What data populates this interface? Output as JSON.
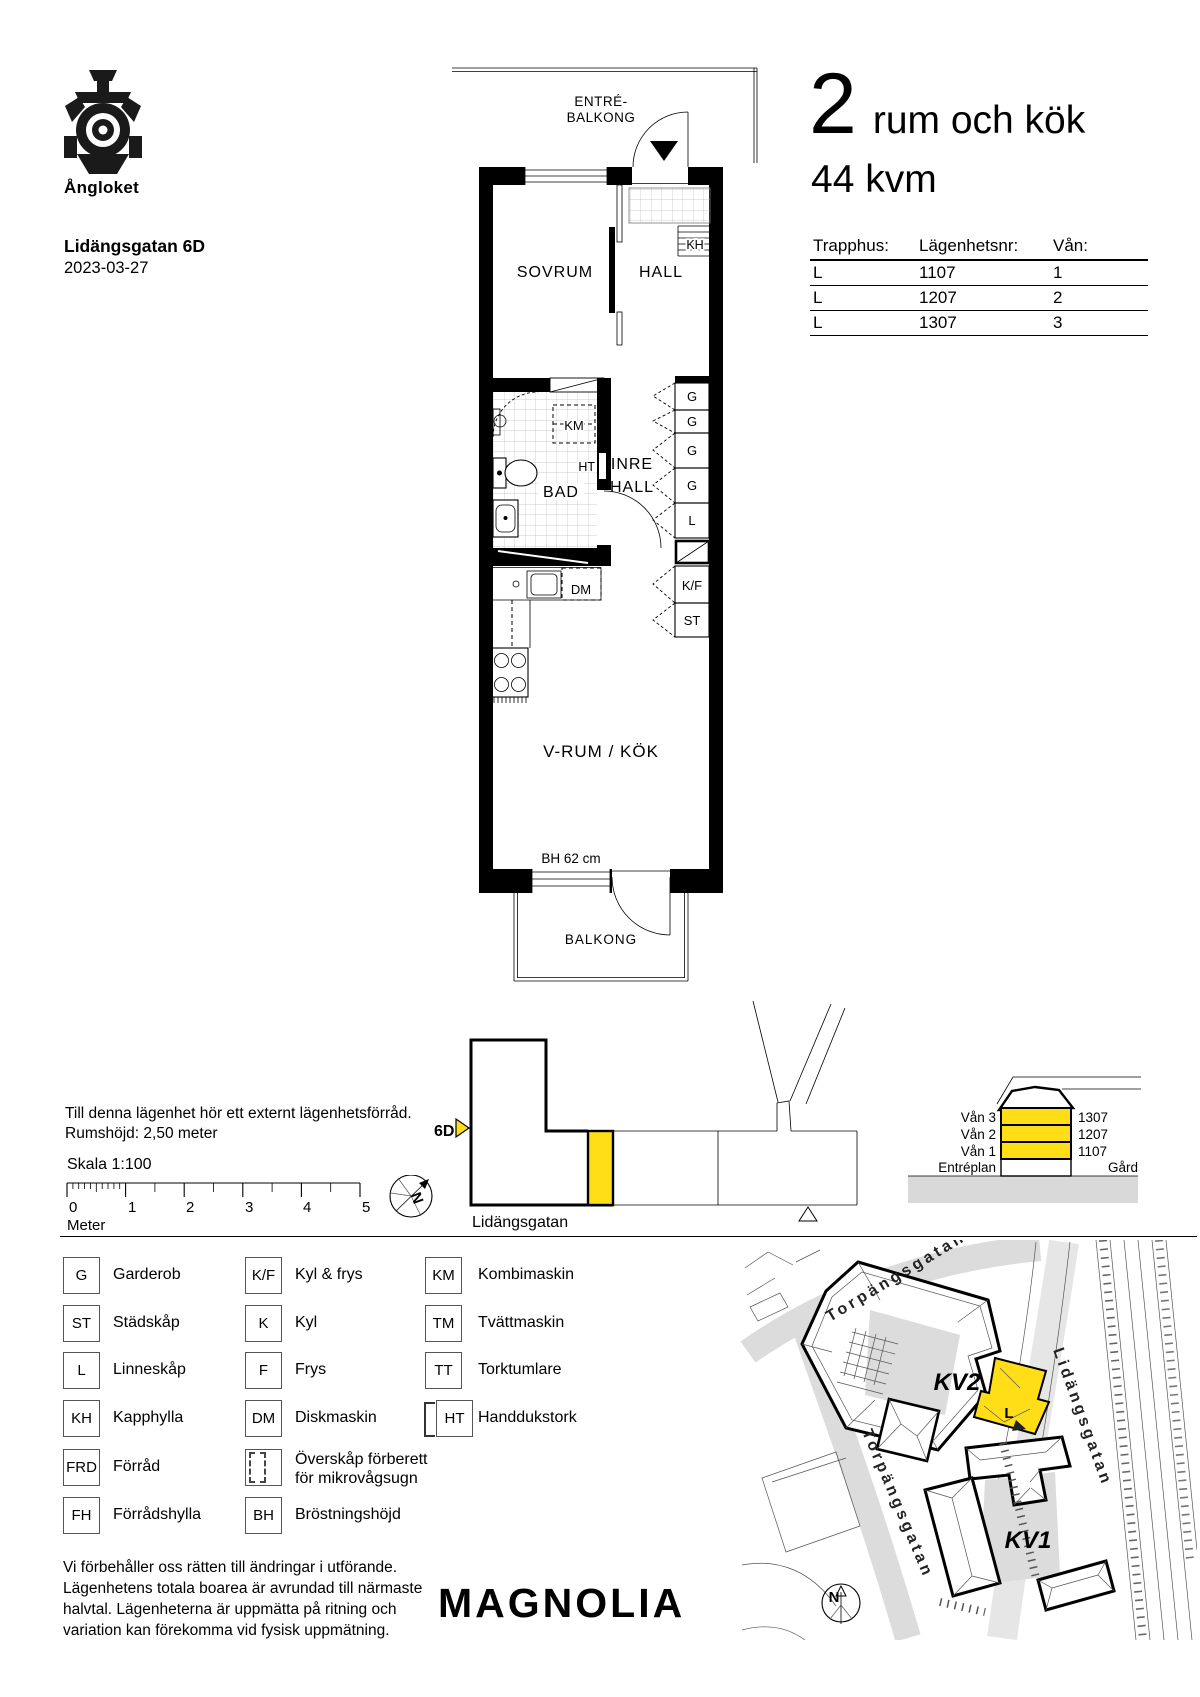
{
  "header": {
    "logo_text": "Ångloket",
    "address": "Lidängsgatan 6D",
    "date": "2023-03-27",
    "rooms_count": "2",
    "rooms_label": "rum och kök",
    "area": "44 kvm"
  },
  "apartments_table": {
    "col_trapphus": "Trapphus:",
    "col_lagenhetsnr": "Lägenhetsnr:",
    "col_van": "Vån:",
    "rows": [
      {
        "trapphus": "L",
        "nr": "1107",
        "van": "1"
      },
      {
        "trapphus": "L",
        "nr": "1207",
        "van": "2"
      },
      {
        "trapphus": "L",
        "nr": "1307",
        "van": "3"
      }
    ]
  },
  "floor_plan": {
    "entre_balkong_line1": "ENTRÉ-",
    "entre_balkong_line2": "BALKONG",
    "sovrum": "SOVRUM",
    "hall": "HALL",
    "kh": "KH",
    "km": "KM",
    "ht": "HT",
    "bad": "BAD",
    "inre_hall_line1": "INRE",
    "inre_hall_line2": "HALL",
    "dm": "DM",
    "closets": [
      "G",
      "G",
      "G",
      "G",
      "L"
    ],
    "kf": "K/F",
    "st": "ST",
    "vrum_kok": "V-RUM / KÖK",
    "bh": "BH 62 cm",
    "balkong": "BALKONG"
  },
  "notes": {
    "line1": "Till denna lägenhet hör ett externt lägenhetsförråd.",
    "line2": "Rumshöjd: 2,50 meter"
  },
  "scale_bar": {
    "title": "Skala 1:100",
    "ticks": [
      "0",
      "1",
      "2",
      "3",
      "4",
      "5"
    ],
    "unit": "Meter",
    "north": "N"
  },
  "site_plan": {
    "unit_marker": "6D",
    "street": "Lidängsgatan"
  },
  "elevation": {
    "floors": [
      {
        "label": "Vån 3",
        "nr": "1307"
      },
      {
        "label": "Vån 2",
        "nr": "1207"
      },
      {
        "label": "Vån 1",
        "nr": "1107"
      }
    ],
    "entrance_level": "Entréplan",
    "yard": "Gård"
  },
  "legend": {
    "col1": [
      {
        "symbol": "G",
        "label": "Garderob"
      },
      {
        "symbol": "ST",
        "label": "Städskåp"
      },
      {
        "symbol": "L",
        "label": "Linneskåp"
      },
      {
        "symbol": "KH",
        "label": "Kapphylla"
      },
      {
        "symbol": "FRD",
        "label": "Förråd"
      },
      {
        "symbol": "FH",
        "label": "Förrådshylla"
      }
    ],
    "col2": [
      {
        "symbol": "K/F",
        "label": "Kyl & frys"
      },
      {
        "symbol": "K",
        "label": "Kyl"
      },
      {
        "symbol": "F",
        "label": "Frys"
      },
      {
        "symbol": "DM",
        "label": "Diskmaskin"
      },
      {
        "symbol": "",
        "label_lines": [
          "Överskåp förberett",
          "för mikrovågsugn"
        ]
      },
      {
        "symbol": "BH",
        "label": "Bröstningshöjd"
      }
    ],
    "col3": [
      {
        "symbol": "KM",
        "label": "Kombimaskin"
      },
      {
        "symbol": "TM",
        "label": "Tvättmaskin"
      },
      {
        "symbol": "TT",
        "label": "Torktumlare"
      },
      {
        "symbol": "HT",
        "label": "Handdukstork"
      }
    ]
  },
  "disclaimer": {
    "lines": [
      "Vi förbehåller oss rätten till ändringar i utförande.",
      "Lägenhetens totala boarea är avrundad till närmaste",
      "halvtal. Lägenheterna är uppmätta på ritning och",
      "variation kan förekomma vid fysisk uppmätning."
    ]
  },
  "brand": "MAGNOLIA",
  "site_map": {
    "street_torpangsgatan_1": "Torpängsgatan",
    "street_torpangsgatan_2": "Torpängsgatan",
    "street_lidangsgatan": "Lidängsgatan",
    "block_kv2": "KV2",
    "block_kv1": "KV1",
    "unit_marker": "L",
    "north": "N"
  },
  "colors": {
    "highlight_yellow": "#FFDE17",
    "ground_gray": "#D9D9D9",
    "street_gray": "#DCDCDC"
  }
}
